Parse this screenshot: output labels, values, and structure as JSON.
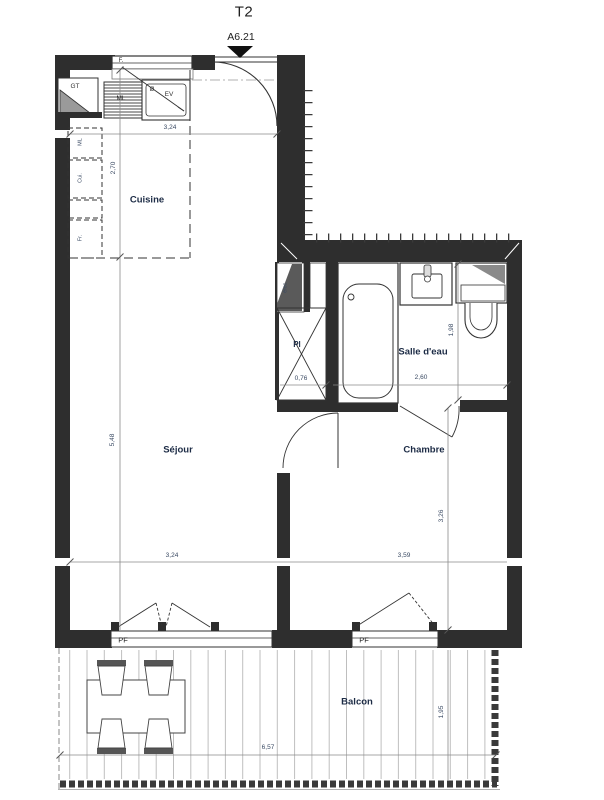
{
  "plan": {
    "title": "T2",
    "marker": "A6.21",
    "rooms": {
      "cuisine": "Cuisine",
      "sejour": "Séjour",
      "chambre": "Chambre",
      "salle_deau": "Salle d'eau",
      "balcon": "Balcon"
    },
    "fixtures": {
      "window": "F.",
      "duct": "GT",
      "washer": "ML",
      "diameter": "Ø",
      "sink": "EV",
      "col_ml": "ML",
      "col_cui": "Cui.",
      "col_fr": "Fr.",
      "elec": "élec.",
      "closet": "Pl",
      "window_sejour": "PF",
      "window_chambre": "PF"
    },
    "dims": {
      "kitchen_w": "3,24",
      "kitchen_d": "2,70",
      "sejour_h": "5,48",
      "sejour_w": "3,24",
      "closet_w": "0,76",
      "sdb_w": "2,60",
      "sdb_d": "1,98",
      "chambre_w": "3,59",
      "chambre_h": "3,26",
      "balcon_w": "6,57",
      "balcon_d": "1,95"
    }
  },
  "colors": {
    "wall": "#2e2e2e",
    "line": "#8a8a8a",
    "dim_text": "#3a4a63",
    "room_text": "#1c2b45"
  }
}
